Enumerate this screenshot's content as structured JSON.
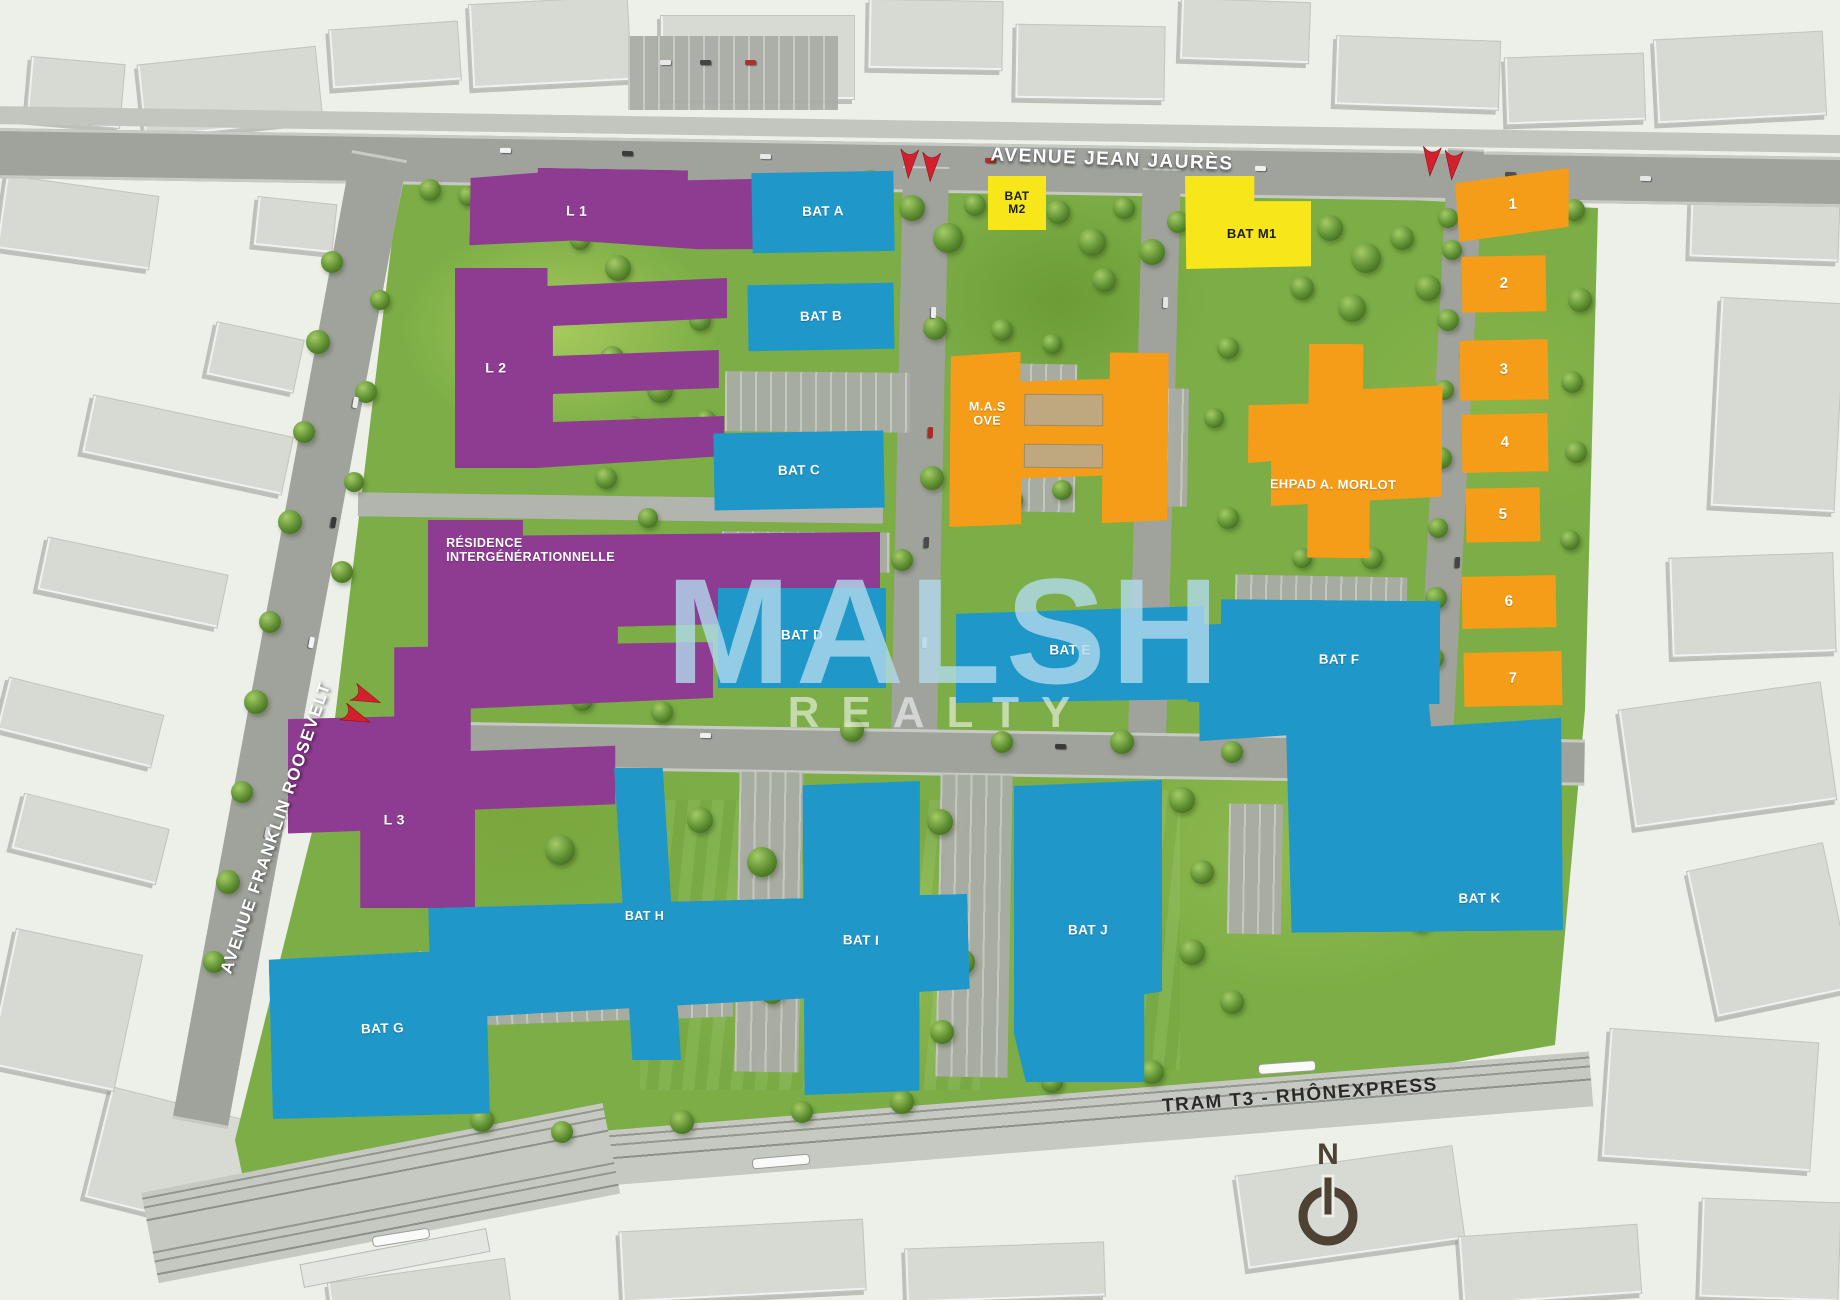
{
  "streets": {
    "top": "AVENUE JEAN JAURÈS",
    "left": "AVENUE FRANKLIN ROOSEVELT",
    "bottom": "TRAM T3 - RHÔNEXPRESS"
  },
  "watermark": {
    "brand": "MALSH",
    "tagline": "REALTY"
  },
  "compass": {
    "north": "N"
  },
  "colors": {
    "residential_purple": "#8e3c92",
    "tertiary_blue": "#1f97c9",
    "public_orange": "#f59d18",
    "commercial_yellow": "#f7e619",
    "arrow_red": "#d2202c",
    "greenspace": "#7cad46"
  },
  "buildings": {
    "purple": {
      "l1": "L 1",
      "l2": "L 2",
      "l3": "L 3",
      "residence": [
        "RÉSIDENCE",
        "INTERGÉNÉRATIONNELLE"
      ]
    },
    "blue": {
      "a": "BAT A",
      "b": "BAT B",
      "c": "BAT C",
      "d": "BAT D",
      "e": "BAT E",
      "f": "BAT F",
      "g": "BAT G",
      "h": "BAT H",
      "i": "BAT I",
      "j": "BAT J",
      "k": "BAT K"
    },
    "yellow": {
      "m1": "BAT M1",
      "m2": [
        "BAT",
        "M2"
      ]
    },
    "orange": {
      "mas": [
        "M.A.S",
        "OVE"
      ],
      "ehpad": "EHPAD A. MORLOT",
      "lots": [
        "1",
        "2",
        "3",
        "4",
        "5",
        "6",
        "7"
      ]
    }
  }
}
